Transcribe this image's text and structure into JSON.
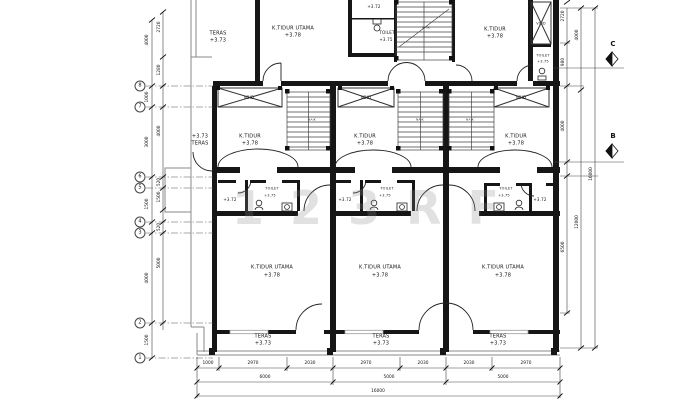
{
  "watermark": "123RF",
  "labels": {
    "teras": "TERAS",
    "ktidur_utama": "K.TIDUR UTAMA",
    "ktidur": "K.TIDUR",
    "toilet": "TOILET",
    "void": "VOID",
    "naik": "NAIK",
    "elev_teras": "+3.73",
    "elev_kamar": "+3.78",
    "elev_toilet": "+3.75",
    "elev_km": "+3.72"
  },
  "grid_bubbles": [
    "8",
    "7",
    "6",
    "5",
    "4",
    "3",
    "2",
    "1"
  ],
  "section_markers": [
    "C",
    "B"
  ],
  "dimensions": {
    "left_outer": [
      "4000",
      "1000",
      "3000",
      "1500",
      "4000",
      "1500"
    ],
    "left_inner": [
      "2720",
      "1280",
      "4000",
      "520",
      "1500",
      "520",
      "5000"
    ],
    "right_inner": [
      "2720",
      "980",
      "4000",
      "6500"
    ],
    "right_mid": [
      "4000",
      "12000"
    ],
    "right_outer": [
      "16000"
    ],
    "bottom_row1": [
      "1000",
      "2970",
      "2030",
      "2970",
      "2030",
      "2030",
      "2970"
    ],
    "bottom_row2": [
      "6000",
      "5000",
      "5000"
    ],
    "bottom_row3": [
      "16000"
    ]
  }
}
